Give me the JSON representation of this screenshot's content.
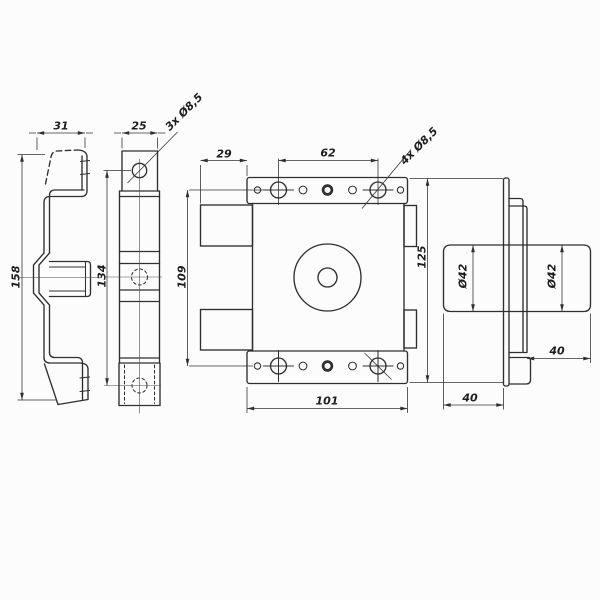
{
  "drawing": {
    "background": "#fcfcfc",
    "line_color": "#2f2f2f",
    "views": {
      "side_profile": {
        "label_width": "31",
        "label_height": "158"
      },
      "strike_front": {
        "label_width": "25",
        "label_holes": "3x Ø8,5",
        "label_height": "134"
      },
      "lock_front": {
        "label_bolt_width": "29",
        "label_hole_spacing": "62",
        "label_holes": "4x Ø8,5",
        "label_hole_rows": "109",
        "label_height": "125",
        "label_width": "101"
      },
      "lock_side": {
        "label_cyl_dia_left": "Ø42",
        "label_cyl_dia_right": "Ø42",
        "label_cyl_len_right": "40",
        "label_cyl_len_left": "40"
      }
    }
  }
}
